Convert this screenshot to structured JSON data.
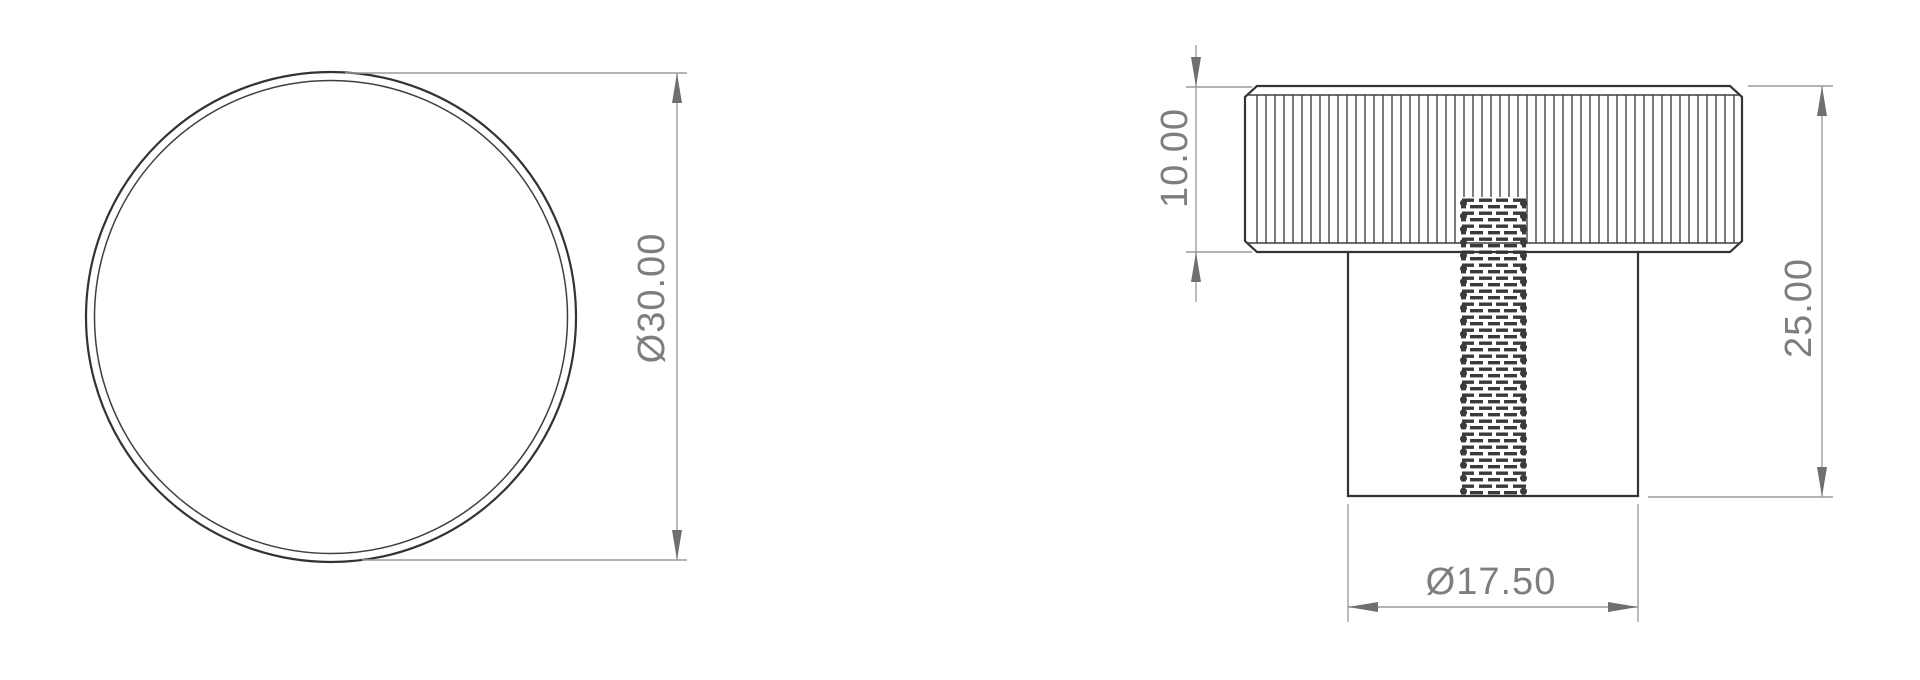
{
  "views": {
    "top": {
      "diameter_label": "Ø30.00"
    },
    "front": {
      "head_height_label": "10.00",
      "total_height_label": "25.00",
      "body_diameter_label": "Ø17.50"
    }
  },
  "colors": {
    "background": "#ffffff",
    "geometry_line": "#333333",
    "dimension_line": "#9c9c9c",
    "dimension_text": "#7e7e7e",
    "arrowhead": "#6f6f6f"
  }
}
